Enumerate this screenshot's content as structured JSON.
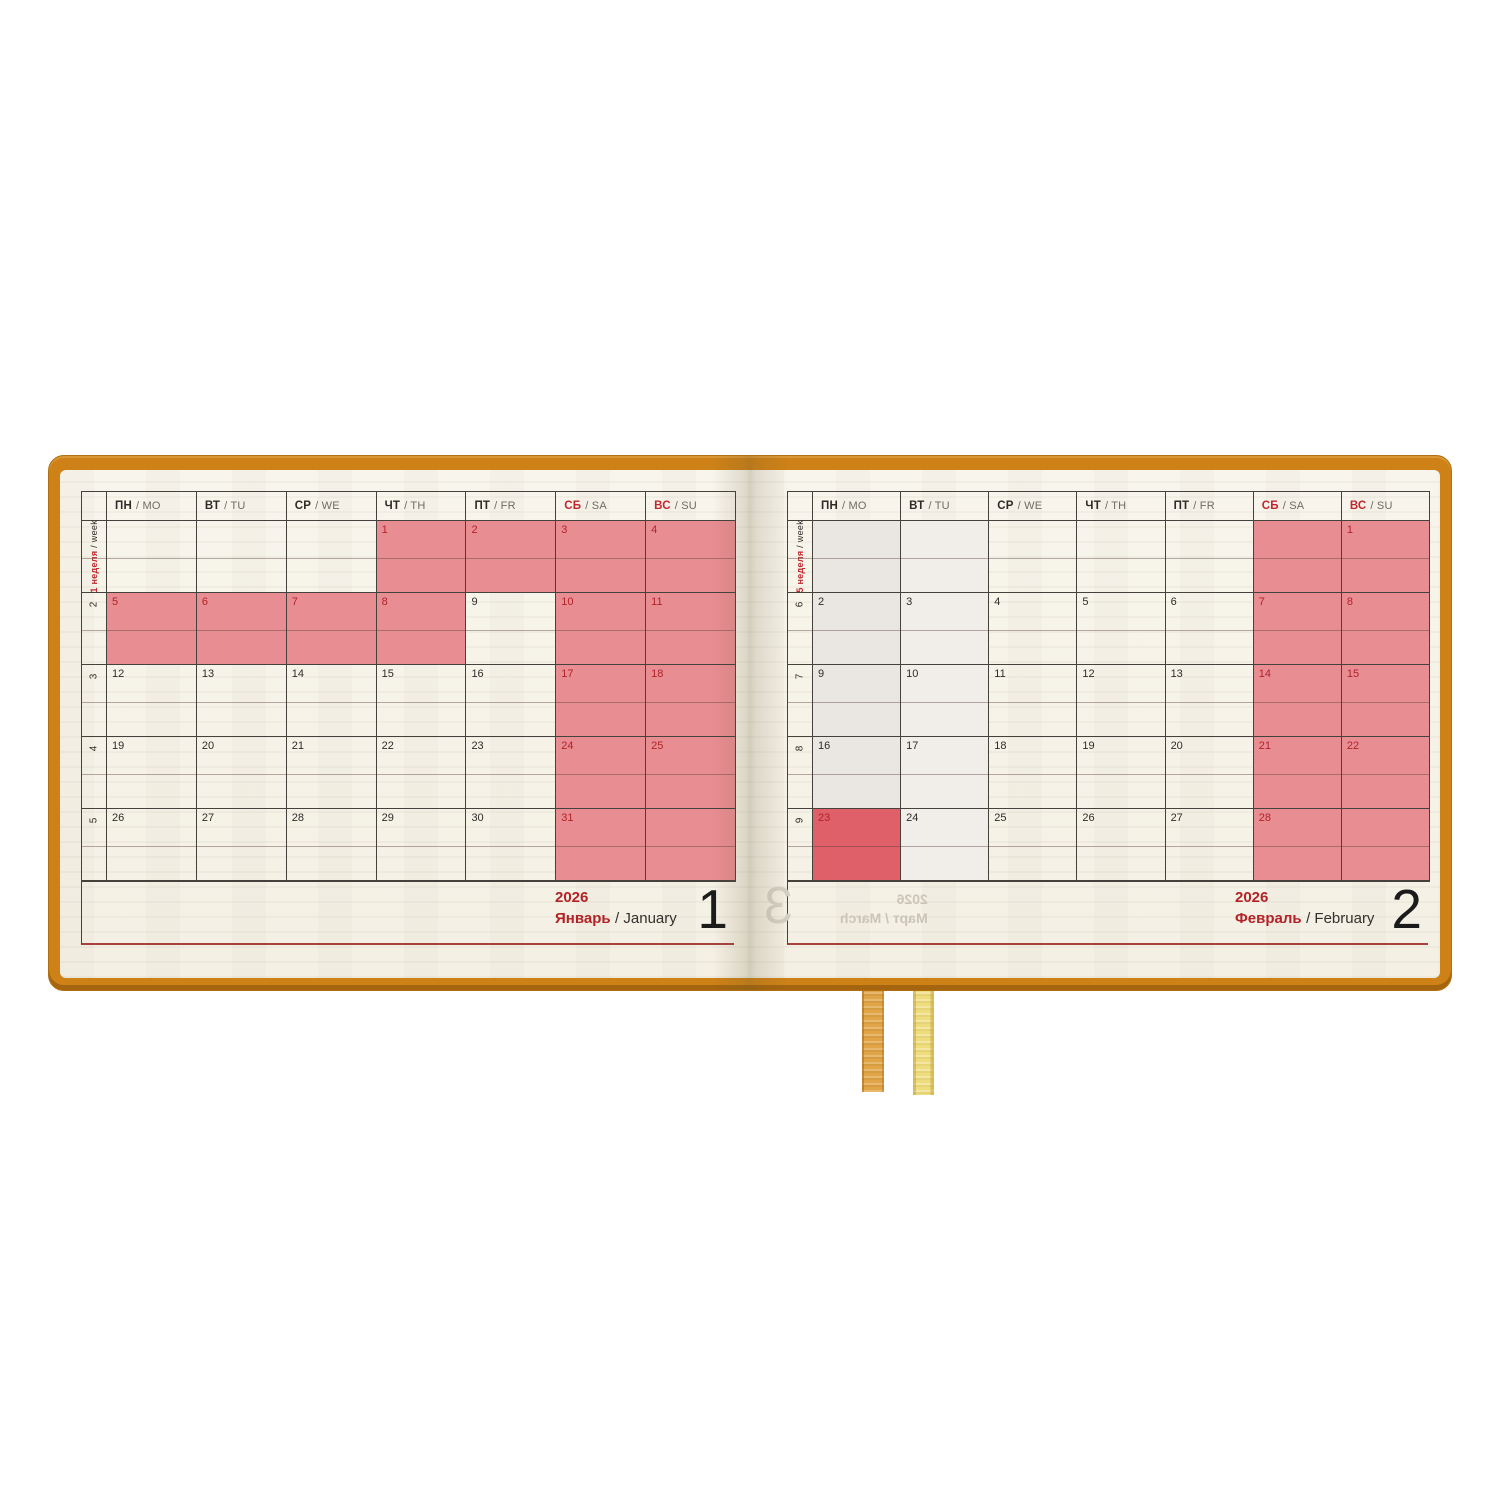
{
  "book": {
    "cover_color": "#cd8117",
    "paper_color": "#f7f4e9",
    "highlight_pink": "#e88d92",
    "highlight_red": "#df6069",
    "accent_red": "#c1272e",
    "ribbon_colors": [
      "#e1a446",
      "#eedc7d"
    ]
  },
  "day_headers": [
    {
      "ru": "ПН",
      "en": "/ MO",
      "weekend": false
    },
    {
      "ru": "ВТ",
      "en": "/ TU",
      "weekend": false
    },
    {
      "ru": "СР",
      "en": "/ WE",
      "weekend": false
    },
    {
      "ru": "ЧТ",
      "en": "/ TH",
      "weekend": false
    },
    {
      "ru": "ПТ",
      "en": "/ FR",
      "weekend": false
    },
    {
      "ru": "СБ",
      "en": "/ SA",
      "weekend": true
    },
    {
      "ru": "ВС",
      "en": "/ SU",
      "weekend": true
    }
  ],
  "left_page": {
    "week_label_red": "1 неделя",
    "week_label_black": "/ week",
    "weeks": [
      {
        "wk": "",
        "cells": [
          {},
          {},
          {},
          {
            "n": "1",
            "hl": "pink",
            "red": true
          },
          {
            "n": "2",
            "hl": "pink",
            "red": true
          },
          {
            "n": "3",
            "hl": "pink",
            "red": true
          },
          {
            "n": "4",
            "hl": "pink",
            "red": true
          }
        ]
      },
      {
        "wk": "2",
        "cells": [
          {
            "n": "5",
            "hl": "pink",
            "red": true
          },
          {
            "n": "6",
            "hl": "pink",
            "red": true
          },
          {
            "n": "7",
            "hl": "pink",
            "red": true
          },
          {
            "n": "8",
            "hl": "pink",
            "red": true
          },
          {
            "n": "9"
          },
          {
            "n": "10",
            "hl": "pink",
            "red": true
          },
          {
            "n": "11",
            "hl": "pink",
            "red": true
          }
        ]
      },
      {
        "wk": "3",
        "cells": [
          {
            "n": "12"
          },
          {
            "n": "13"
          },
          {
            "n": "14"
          },
          {
            "n": "15"
          },
          {
            "n": "16"
          },
          {
            "n": "17",
            "hl": "pink",
            "red": true
          },
          {
            "n": "18",
            "hl": "pink",
            "red": true
          }
        ]
      },
      {
        "wk": "4",
        "cells": [
          {
            "n": "19"
          },
          {
            "n": "20"
          },
          {
            "n": "21"
          },
          {
            "n": "22"
          },
          {
            "n": "23"
          },
          {
            "n": "24",
            "hl": "pink",
            "red": true
          },
          {
            "n": "25",
            "hl": "pink",
            "red": true
          }
        ]
      },
      {
        "wk": "5",
        "cells": [
          {
            "n": "26"
          },
          {
            "n": "27"
          },
          {
            "n": "28"
          },
          {
            "n": "29"
          },
          {
            "n": "30"
          },
          {
            "n": "31",
            "hl": "pink",
            "red": true
          },
          {
            "hl": "pink"
          }
        ]
      }
    ],
    "footer": {
      "year": "2026",
      "month_ru": "Январь",
      "month_en": "/ January",
      "page_number": "1"
    }
  },
  "right_page": {
    "week_label_red": "5 неделя",
    "week_label_black": "/ week",
    "weeks": [
      {
        "wk": "",
        "cells": [
          {
            "tint": 1
          },
          {
            "tint": 2
          },
          {},
          {},
          {},
          {
            "hl": "pink"
          },
          {
            "n": "1",
            "hl": "pink",
            "red": true
          }
        ]
      },
      {
        "wk": "6",
        "cells": [
          {
            "n": "2",
            "tint": 1
          },
          {
            "n": "3",
            "tint": 2
          },
          {
            "n": "4"
          },
          {
            "n": "5"
          },
          {
            "n": "6"
          },
          {
            "n": "7",
            "hl": "pink",
            "red": true
          },
          {
            "n": "8",
            "hl": "pink",
            "red": true
          }
        ]
      },
      {
        "wk": "7",
        "cells": [
          {
            "n": "9",
            "tint": 1
          },
          {
            "n": "10",
            "tint": 2
          },
          {
            "n": "11"
          },
          {
            "n": "12"
          },
          {
            "n": "13"
          },
          {
            "n": "14",
            "hl": "pink",
            "red": true
          },
          {
            "n": "15",
            "hl": "pink",
            "red": true
          }
        ]
      },
      {
        "wk": "8",
        "cells": [
          {
            "n": "16",
            "tint": 1
          },
          {
            "n": "17",
            "tint": 2
          },
          {
            "n": "18"
          },
          {
            "n": "19"
          },
          {
            "n": "20"
          },
          {
            "n": "21",
            "hl": "pink",
            "red": true
          },
          {
            "n": "22",
            "hl": "pink",
            "red": true
          }
        ]
      },
      {
        "wk": "9",
        "cells": [
          {
            "n": "23",
            "hl": "red",
            "red": true
          },
          {
            "n": "24",
            "tint": 2
          },
          {
            "n": "25"
          },
          {
            "n": "26"
          },
          {
            "n": "27"
          },
          {
            "n": "28",
            "hl": "pink",
            "red": true
          },
          {
            "hl": "pink"
          }
        ]
      }
    ],
    "footer": {
      "year": "2026",
      "month_ru": "Февраль",
      "month_en": "/ February",
      "page_number": "2"
    },
    "ghost": {
      "year": "2026",
      "month": "Март / March",
      "page_number": "3"
    }
  }
}
